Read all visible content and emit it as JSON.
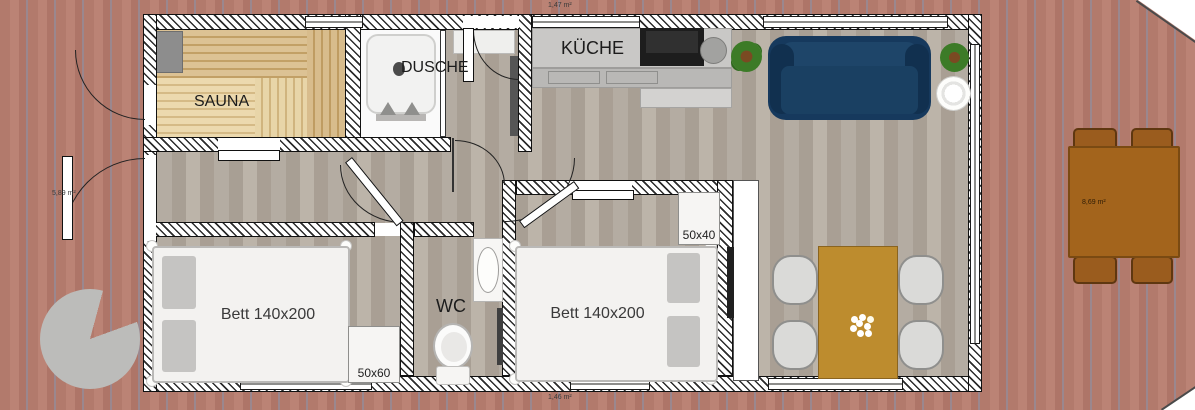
{
  "floorplan": {
    "rooms": {
      "sauna": {
        "label": "SAUNA"
      },
      "shower": {
        "label": "DUSCHE"
      },
      "kitchen": {
        "label": "KÜCHE"
      },
      "wc": {
        "label": "WC"
      },
      "bedroom_left": {
        "bed_label": "Bett 140x200",
        "cabinet_label": "50x60"
      },
      "bedroom_middle": {
        "bed_label": "Bett 140x200",
        "cabinet_label": "50x40"
      }
    },
    "annotations": {
      "area_top": "1,47 m²",
      "area_left": "5,89 m²",
      "area_bottom": "1,46 m²",
      "area_terrace_table": "8,69 m²"
    },
    "colors": {
      "terrace_deck": "#b27a6c",
      "interior_floor": "#b0a89e",
      "sauna_wood": "#d9bd8d",
      "sofa_navy": "#16395d",
      "dining_table_gold": "#bd8c2e",
      "outdoor_table_brown": "#a3641c",
      "wall_hatch": "#2b2b2b",
      "stone_circle_gray": "#bcbcba"
    }
  }
}
